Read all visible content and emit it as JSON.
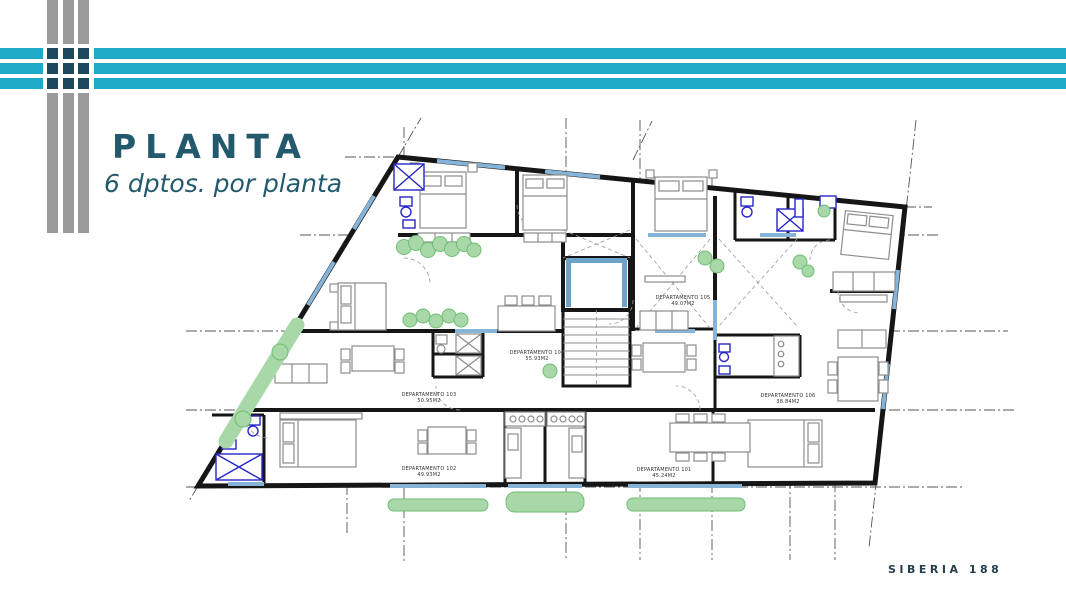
{
  "slide": {
    "title": "PLANTA",
    "subtitle": "6 dptos. por planta",
    "footer": "SIBERIA 188"
  },
  "colors": {
    "accent_cyan": "#1faac8",
    "bar_gray": "#9b9b9b",
    "intersection_navy": "#1c4a5c",
    "title_teal": "#23596c",
    "footer_slate": "#263f4d",
    "plan_wall_black": "#161616",
    "plan_window_blue": "#85b4d8",
    "plan_fixture_blue": "#2626c8",
    "plan_green": "#a8d8a8"
  },
  "plan": {
    "apartments": [
      {
        "name": "DEPARTAMENTO 101",
        "area": "45.24M2"
      },
      {
        "name": "DEPARTAMENTO 102",
        "area": "49.93M2"
      },
      {
        "name": "DEPARTAMENTO 103",
        "area": "50.95M2"
      },
      {
        "name": "DEPARTAMENTO 104",
        "area": "55.93M2"
      },
      {
        "name": "DEPARTAMENTO 105",
        "area": "49.07M2"
      },
      {
        "name": "DEPARTAMENTO 106",
        "area": "38.84M2"
      }
    ]
  }
}
